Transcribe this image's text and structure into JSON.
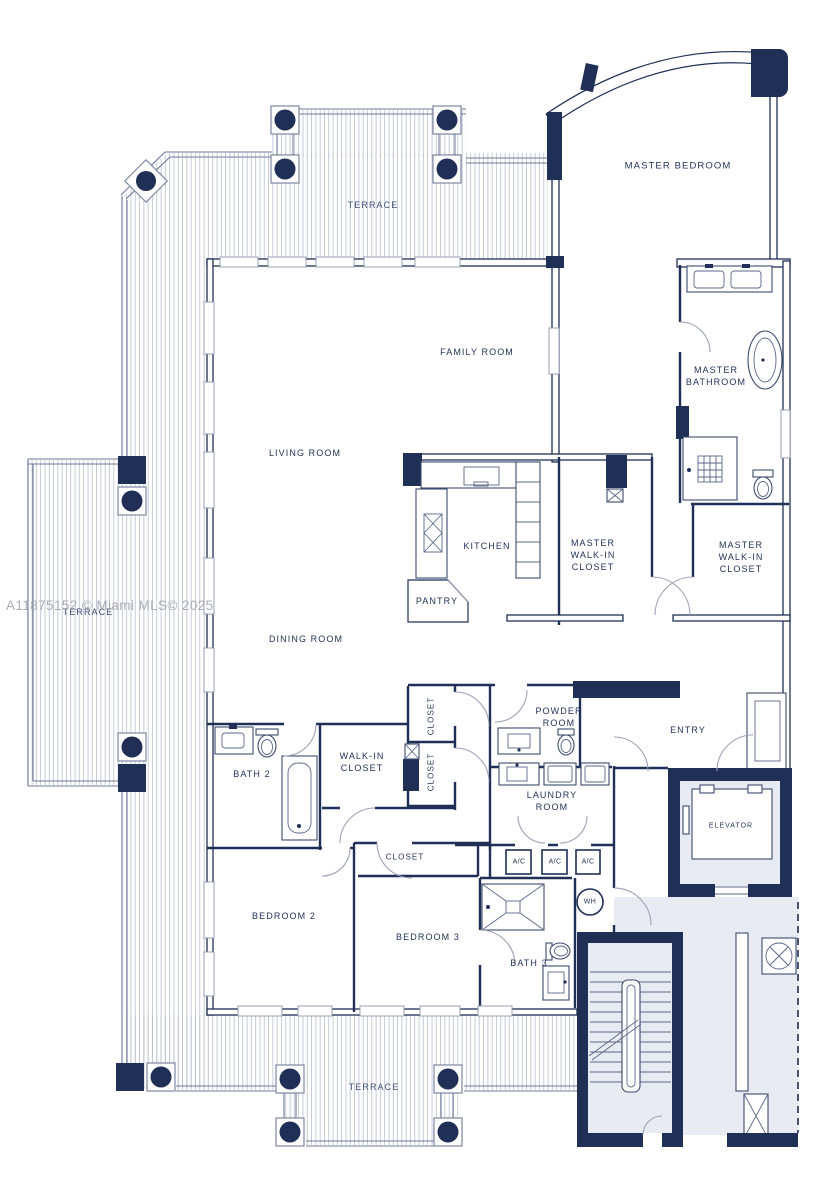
{
  "colors": {
    "ink": "#1f2f55",
    "shade": "#e8ecf2",
    "hatch": "#b6bece",
    "rail": "#6d7899",
    "arc": "#9aa2b6",
    "wm": "#9ba1ad"
  },
  "watermark": "A11875152 © Miami MLS© 2025",
  "rooms": {
    "terrace": "TERRACE",
    "master_bedroom": "MASTER BEDROOM",
    "family_room": "FAMILY ROOM",
    "living_room": "LIVING ROOM",
    "dining_room": "DINING ROOM",
    "kitchen": "KITCHEN",
    "pantry": "PANTRY",
    "master_walk_in_closet": "MASTER\nWALK-IN\nCLOSET",
    "master_bathroom": "MASTER\nBATHROOM",
    "powder_room": "POWDER\nROOM",
    "laundry_room": "LAUNDRY\nROOM",
    "entry": "ENTRY",
    "elevator": "ELEVATOR",
    "bath_2": "BATH 2",
    "walk_in_closet": "WALK-IN\nCLOSET",
    "closet": "CLOSET",
    "bedroom_2": "BEDROOM 2",
    "bedroom_3": "BEDROOM 3",
    "bath_3": "BATH 3",
    "ac": "A/C",
    "water_heater": "WH"
  }
}
